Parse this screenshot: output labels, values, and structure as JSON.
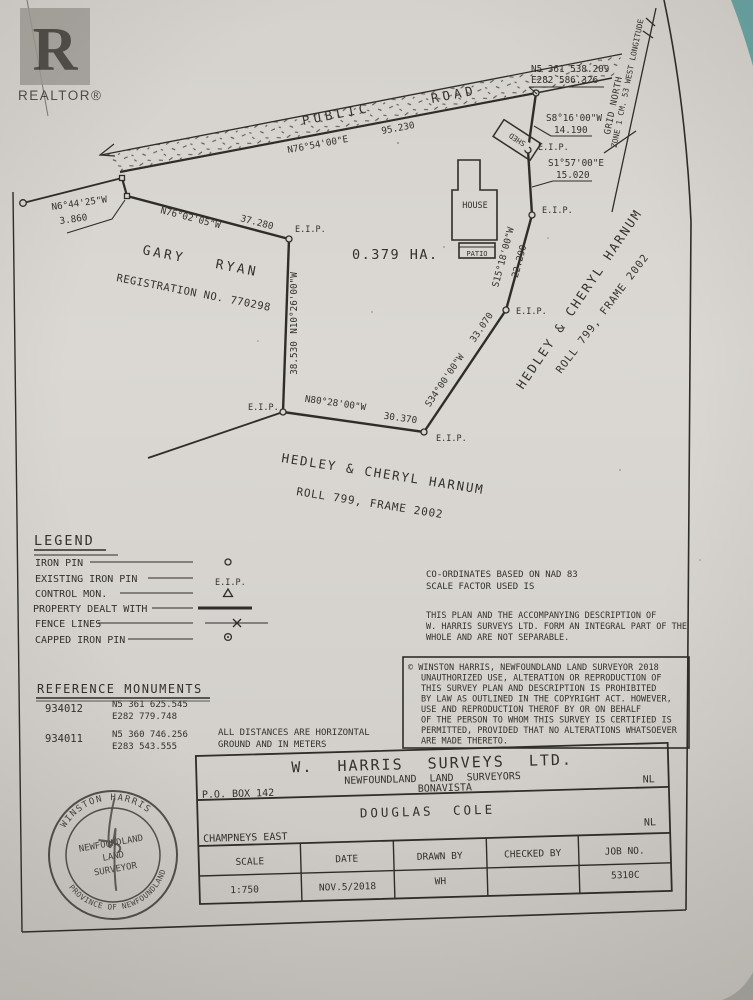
{
  "watermark": {
    "letter": "R",
    "label": "REALTOR®"
  },
  "road": {
    "label_left": "PUBLIC",
    "label_right": "ROAD",
    "bearing": "N76°54'00\"E",
    "distance": "95.230"
  },
  "grid": {
    "north_label": "GRID NORTH",
    "zone_label": "ZONE 1 CM. 53 WEST LONGITUDE"
  },
  "corner_coordinates": {
    "northing": "N5 361 538.209",
    "easting": "E282 586.326"
  },
  "labels": {
    "eip": "E.I.P.",
    "area": "0.379 HA.",
    "house": "HOUSE",
    "patio": "PATIO",
    "shed": "SHED"
  },
  "boundaries": [
    {
      "id": "tie",
      "bearing": "N6°44'25\"W",
      "distance": "3.860"
    },
    {
      "id": "north",
      "bearing": "N76°02'05\"W",
      "distance": "37.280"
    },
    {
      "id": "west",
      "bearing": "N10°26'00\"W",
      "distance": "38.530"
    },
    {
      "id": "south",
      "bearing": "N80°28'00\"W",
      "distance": "30.370"
    },
    {
      "id": "southeast",
      "bearing": "S34°00'00\"W",
      "distance": "33.070"
    },
    {
      "id": "east-lower",
      "bearing": "S15°18'00\"W",
      "distance": "22.290"
    },
    {
      "id": "east-mid",
      "bearing": "S1°57'00\"E",
      "distance": "15.020"
    },
    {
      "id": "east-upper",
      "bearing": "S8°16'00\"W",
      "distance": "14.190"
    }
  ],
  "adjoiners": {
    "west": {
      "name_a": "GARY",
      "name_b": "RYAN",
      "registration": "REGISTRATION NO. 770298"
    },
    "south": {
      "name": "HEDLEY & CHERYL HARNUM",
      "roll": "ROLL 799, FRAME 2002"
    },
    "east": {
      "name": "HEDLEY & CHERYL HARNUM",
      "roll": "ROLL 799, FRAME 2002"
    }
  },
  "legend": {
    "title": "LEGEND",
    "items": [
      {
        "label": "IRON PIN",
        "symbol": "circle"
      },
      {
        "label": "EXISTING IRON PIN",
        "symbol": "text",
        "symbol_text": "E.I.P."
      },
      {
        "label": "CONTROL MON.",
        "symbol": "triangle"
      },
      {
        "label": "PROPERTY DEALT WITH",
        "symbol": "thick-line"
      },
      {
        "label": "FENCE LINES",
        "symbol": "fence-line"
      },
      {
        "label": "CAPPED IRON PIN",
        "symbol": "capped-circle"
      }
    ]
  },
  "notes": {
    "datum": [
      "CO-ORDINATES BASED ON NAD 83",
      "SCALE FACTOR USED IS"
    ],
    "integral": [
      "THIS PLAN AND THE ACCOMPANYING DESCRIPTION OF",
      "W. HARRIS SURVEYS LTD. FORM AN INTEGRAL PART OF THE",
      "WHOLE AND ARE NOT SEPARABLE."
    ],
    "copyright": [
      "© WINSTON HARRIS, NEWFOUNDLAND LAND SURVEYOR 2018",
      "UNAUTHORIZED USE, ALTERATION OR REPRODUCTION OF",
      "THIS SURVEY PLAN AND DESCRIPTION IS PROHIBITED",
      "BY LAW AS OUTLINED IN THE COPYRIGHT ACT. HOWEVER,",
      "USE AND REPRODUCTION THEROF BY OR ON BEHALF",
      "OF THE PERSON TO WHOM THIS SURVEY IS CERTIFIED IS",
      "PERMITTED, PROVIDED THAT NO ALTERATIONS WHATSOEVER",
      "ARE MADE THERETO."
    ]
  },
  "reference_monuments": {
    "title": "REFERENCE MONUMENTS",
    "rows": [
      {
        "id": "934012",
        "northing": "N5 361 625.545",
        "easting": "E282 779.748"
      },
      {
        "id": "934011",
        "northing": "N5 360 746.256",
        "easting": "E283 543.555"
      }
    ],
    "note": [
      "ALL DISTANCES ARE HORIZONTAL",
      "GROUND AND IN METERS"
    ]
  },
  "title_block": {
    "company": "W. HARRIS SURVEYS LTD.",
    "subtitle": "NEWFOUNDLAND LAND SURVEYORS",
    "town": "BONAVISTA",
    "po_box": "P.O. BOX 142",
    "province1": "NL",
    "client": "DOUGLAS COLE",
    "location": "CHAMPNEYS EAST",
    "province2": "NL",
    "columns": [
      "SCALE",
      "DATE",
      "DRAWN BY",
      "CHECKED BY",
      "JOB NO."
    ],
    "values": [
      "1:750",
      "NOV.5/2018",
      "WH",
      "",
      "5310C"
    ]
  },
  "stamp": {
    "top": "WINSTON HARRIS",
    "bottom": "PROVINCE OF NEWFOUNDLAND",
    "center": [
      "NEWFOUNDLAND",
      "LAND",
      "SURVEYOR"
    ]
  }
}
